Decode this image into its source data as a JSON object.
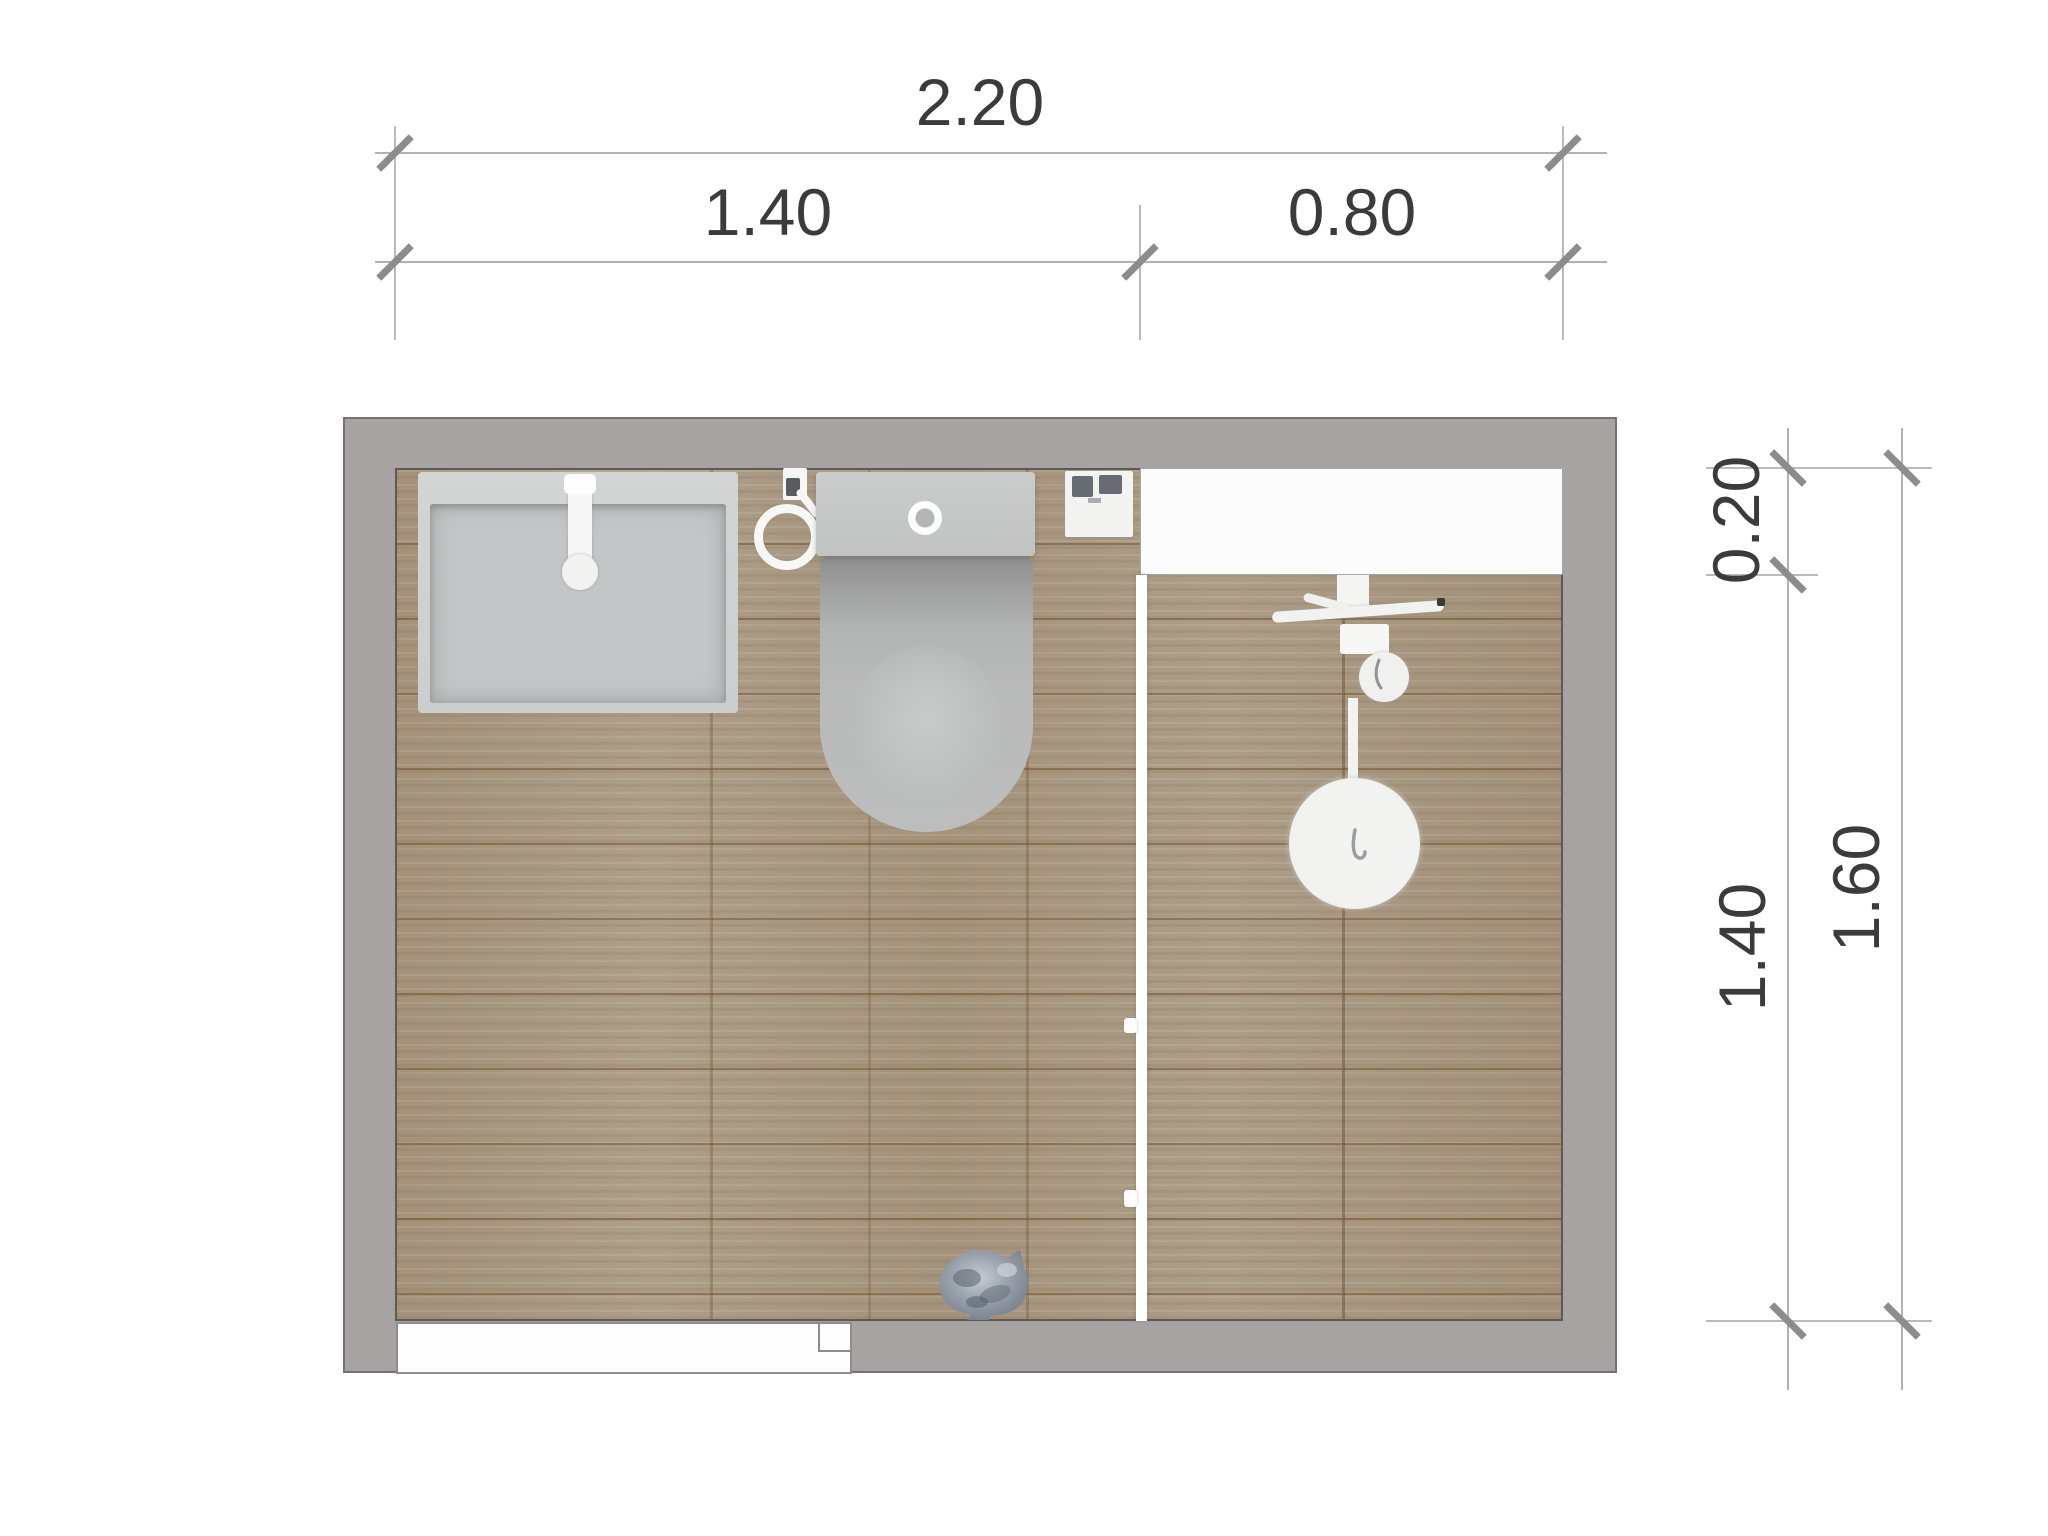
{
  "drawing": {
    "type": "bathroom-floor-plan-top-view",
    "dimensions": {
      "top": {
        "total": "2.20",
        "segment_left": "1.40",
        "segment_right": "0.80"
      },
      "right": {
        "niche_depth": "0.20",
        "room_depth": "1.40",
        "total": "1.60"
      }
    },
    "fixtures": [
      "washbasin",
      "faucet",
      "toilet-paper-holder",
      "toilet",
      "flush-button",
      "wall-mounted-box",
      "shower-niche",
      "glass-partition",
      "shower-mixer",
      "hand-shower",
      "shower-head",
      "door-opening",
      "cat"
    ],
    "colors": {
      "wall": "#a7a3a3",
      "wall_outline": "#76716f",
      "floor_wood": "#a8977f",
      "plank_line": "#7a5838",
      "fixture_white": "#f5f5f4",
      "fixture_gray": "#c3c6c6",
      "niche_white": "#fcfcfc",
      "dim_text": "#3b3b3b",
      "dim_line": "#b3b1b1",
      "dim_tick": "#8c8c8c",
      "cat_gray": "#8d97a2"
    }
  }
}
